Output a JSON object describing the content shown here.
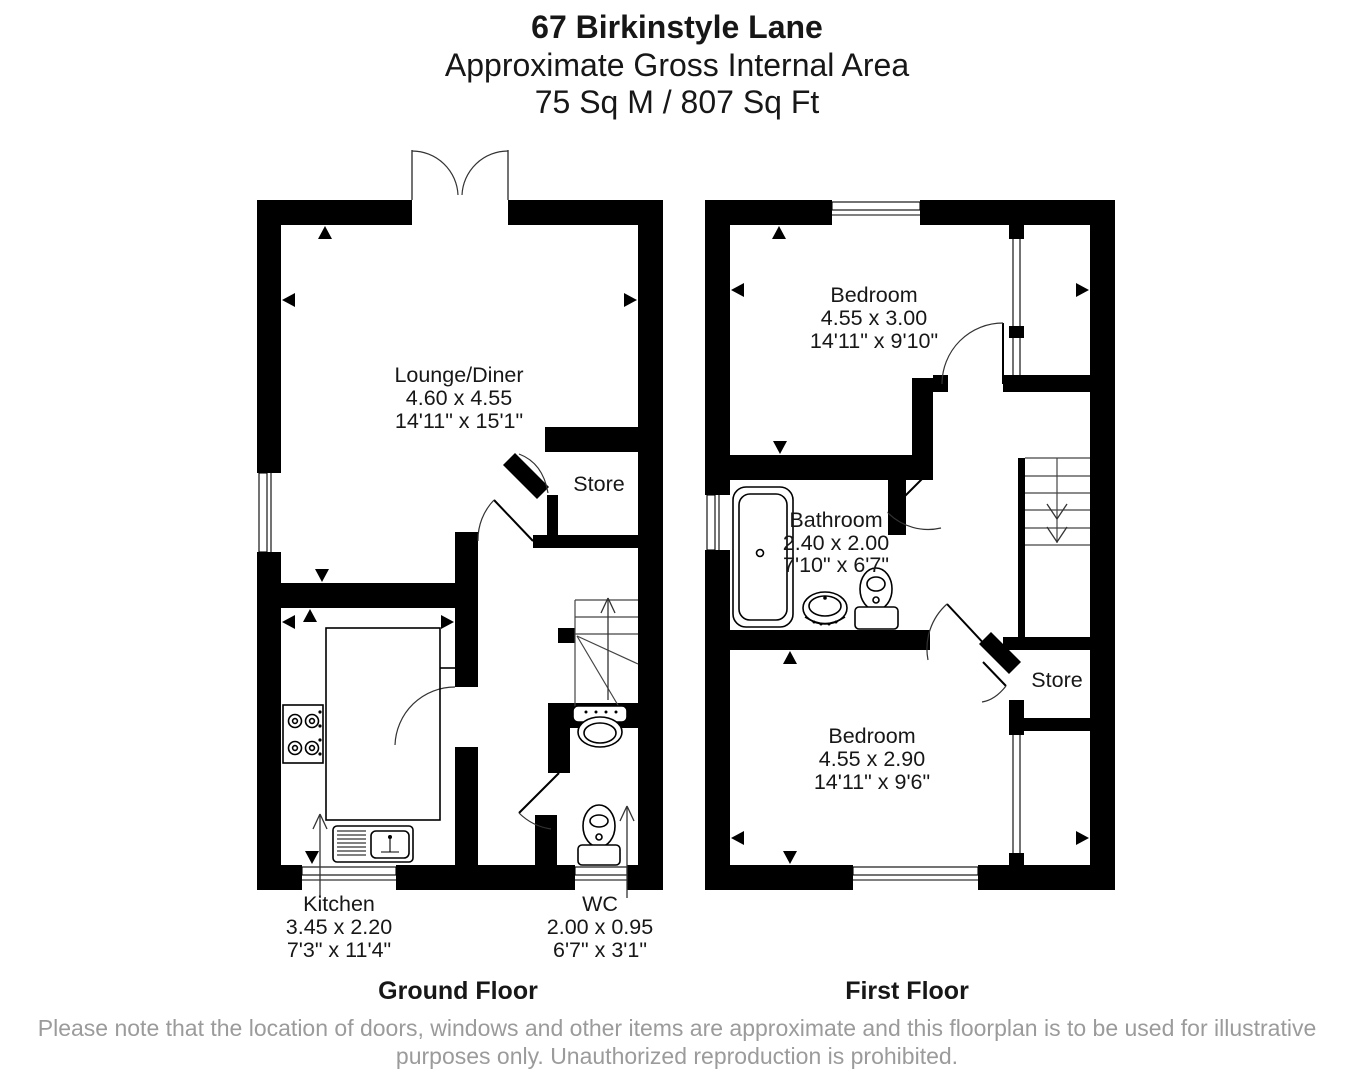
{
  "header": {
    "address": "67 Birkinstyle Lane",
    "subtitle": "Approximate Gross Internal Area",
    "area": "75 Sq M / 807 Sq Ft"
  },
  "floors": [
    {
      "label": "Ground Floor",
      "rooms": [
        {
          "name": "Lounge/Diner",
          "metric": "4.60 x 4.55",
          "imperial": "14'11\" x 15'1\""
        },
        {
          "name": "Store"
        },
        {
          "name": "Kitchen",
          "metric": "3.45 x 2.20",
          "imperial": "7'3\" x 11'4\""
        },
        {
          "name": "WC",
          "metric": "2.00 x 0.95",
          "imperial": "6'7\" x 3'1\""
        }
      ]
    },
    {
      "label": "First Floor",
      "rooms": [
        {
          "name": "Bedroom",
          "metric": "4.55 x 3.00",
          "imperial": "14'11\" x 9'10\""
        },
        {
          "name": "Bathroom",
          "metric": "2.40 x 2.00",
          "imperial": "7'10\" x 6'7\""
        },
        {
          "name": "Store"
        },
        {
          "name": "Bedroom",
          "metric": "4.55 x 2.90",
          "imperial": "14'11\" x 9'6\""
        }
      ]
    }
  ],
  "disclaimer": {
    "line1": "Please note that the location of doors, windows and other items are approximate and this floorplan is to be used for illustrative",
    "line2": "purposes only. Unauthorized reproduction is prohibited."
  },
  "colors": {
    "wall": "#000000",
    "text": "#171717",
    "disclaimer": "#9b9b9b",
    "background": "#ffffff"
  }
}
